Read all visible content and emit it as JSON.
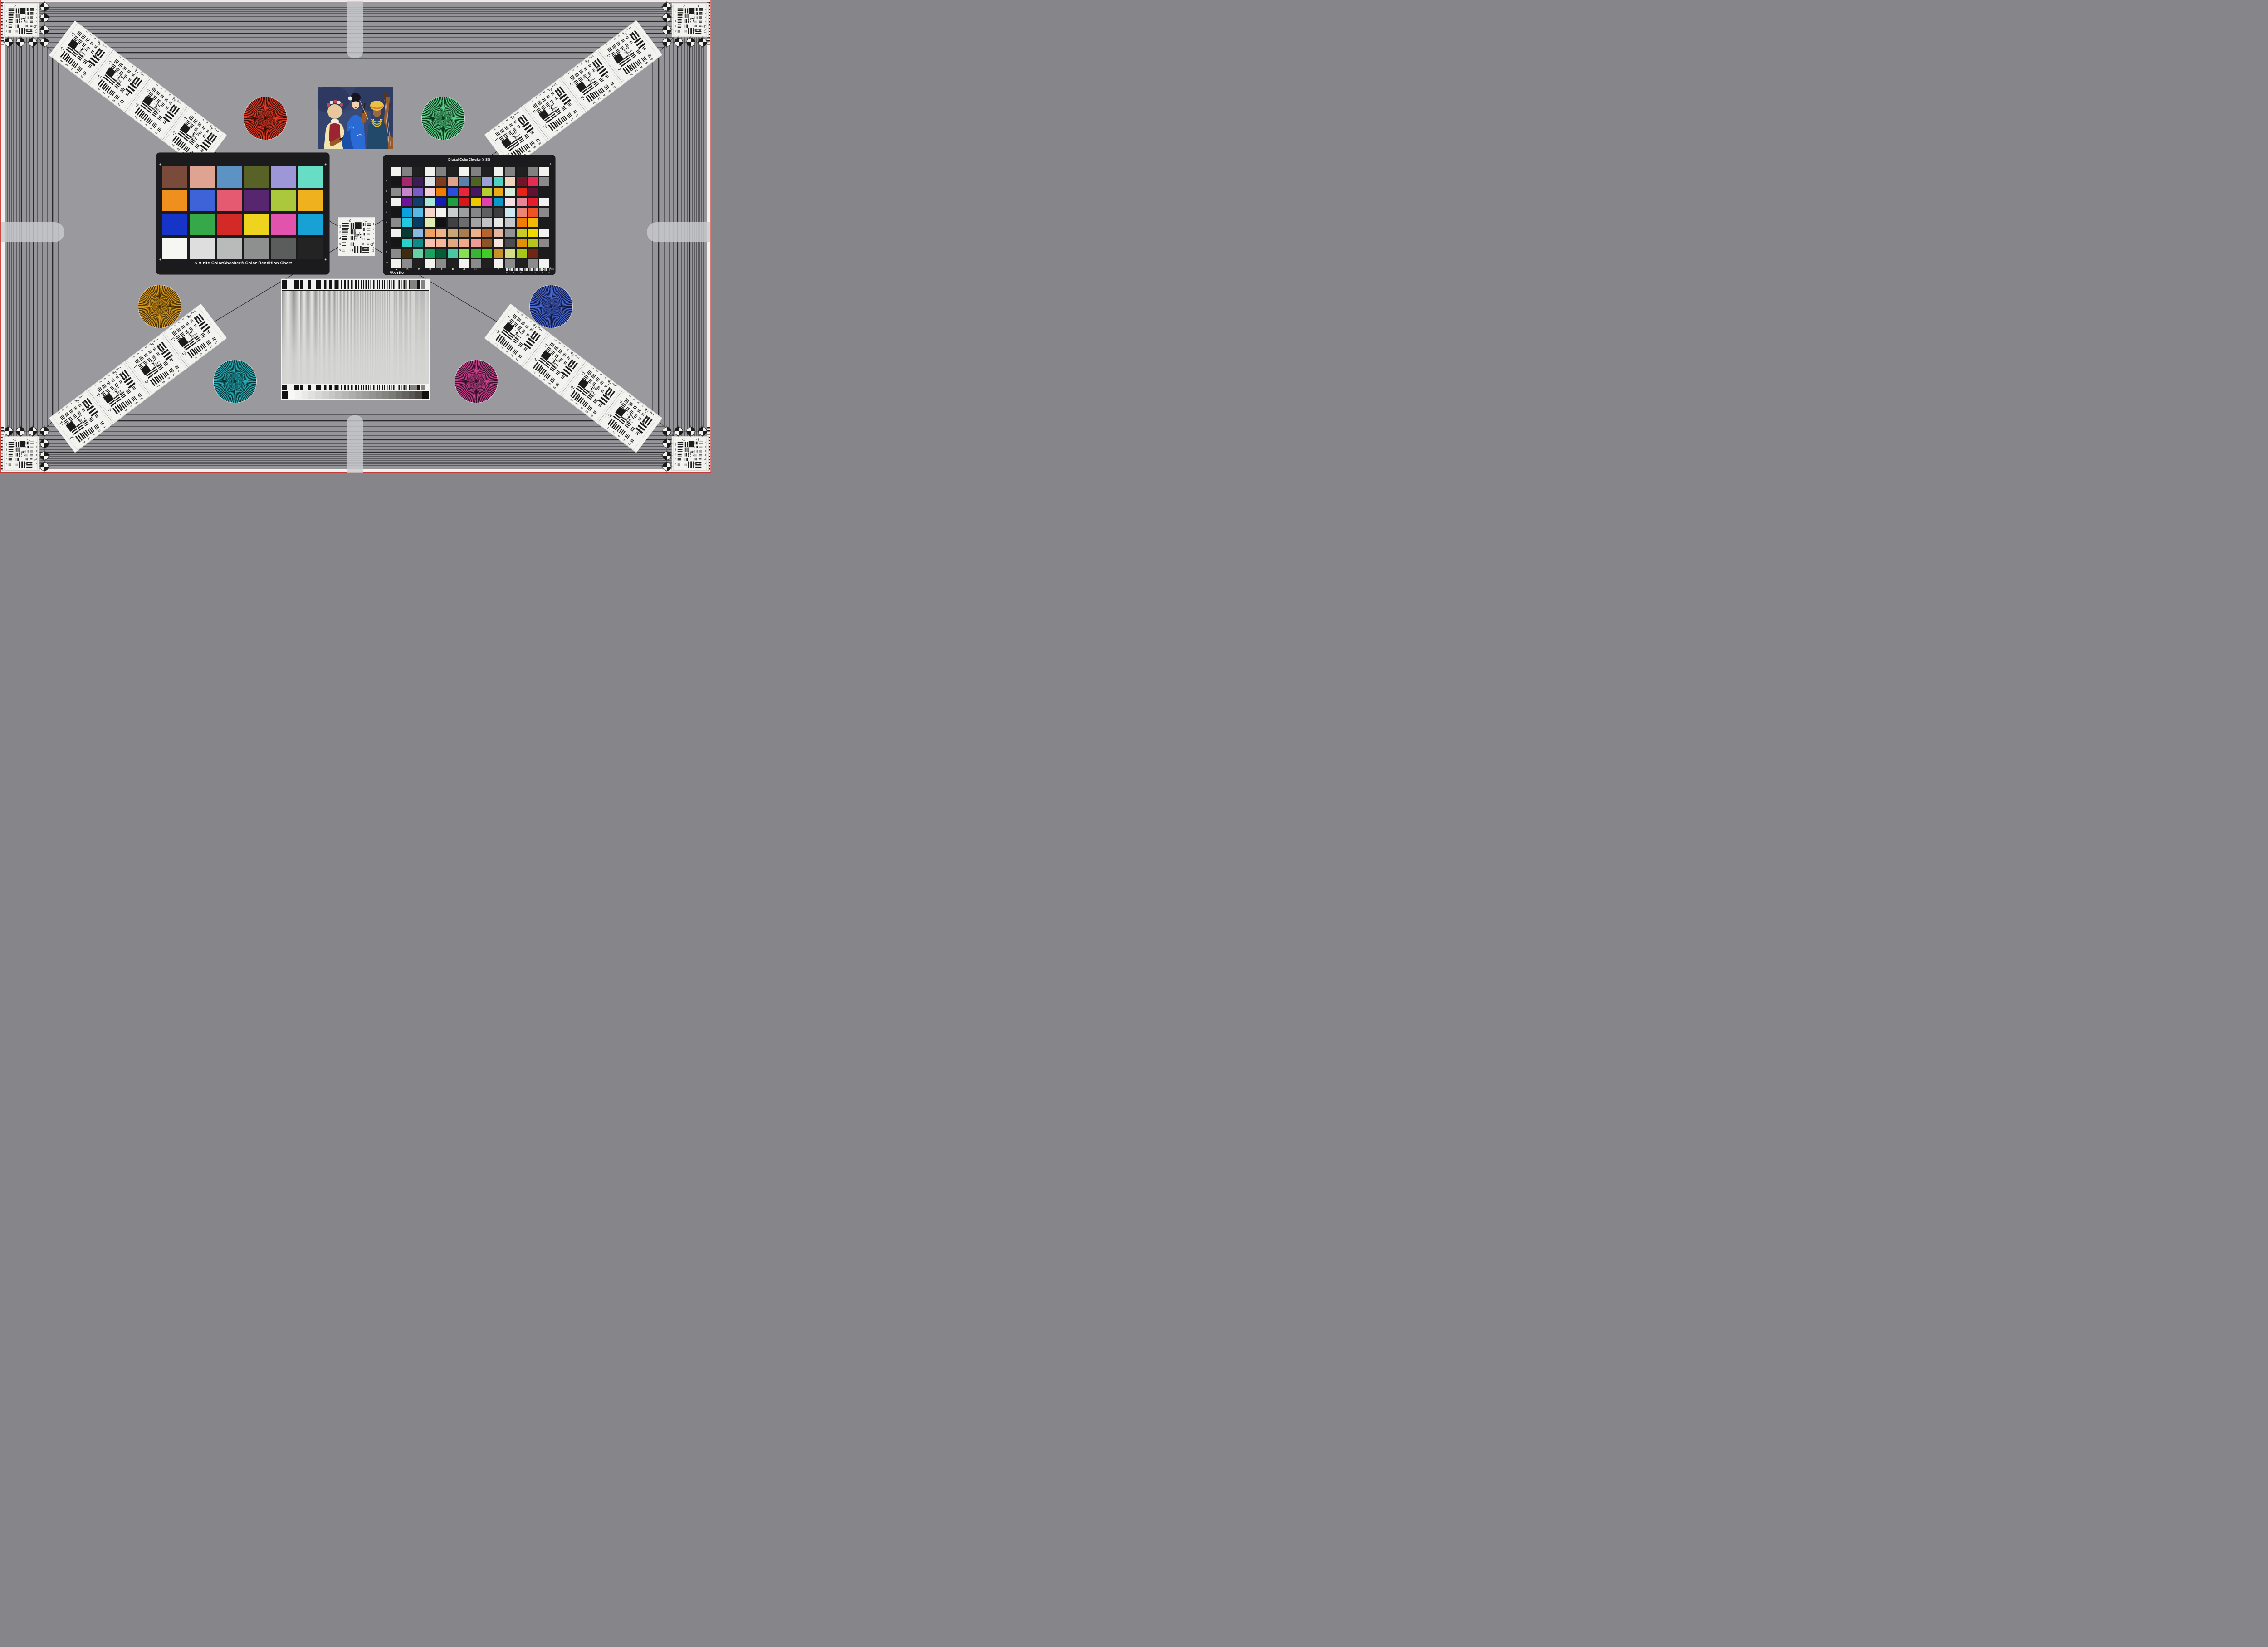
{
  "colors": {
    "background": "#96969a",
    "inner_background": "#9a9a9e",
    "frame_line": "#2a2a2d",
    "diagonal_line": "#26262a",
    "card_black": "#1b1b1d",
    "edge_red": "#c84640",
    "edge_white": "#f1f1ef",
    "arm_gray": "#c9cbce",
    "white_patch": "#f2f2ee",
    "star_rim": "#d4d4d6",
    "usaf_ink": "#1c1c1c"
  },
  "usaf": {
    "top_labels": [
      "-2",
      "-1"
    ],
    "left_labels": [
      "2",
      "3",
      "4",
      "5",
      "6"
    ],
    "right_labels": [
      "1",
      "2",
      "3",
      "4",
      "5",
      "6"
    ],
    "bottom_labels": [
      "-2",
      "1"
    ],
    "center_labels": [
      "0",
      "1"
    ]
  },
  "colorchecker": {
    "logo_text": "x-rite",
    "title": "ColorChecker® Color Rendition Chart",
    "corner_mark": "+",
    "patches": [
      "#7a4b3a",
      "#dfa491",
      "#5d92c4",
      "#586226",
      "#9e97d7",
      "#67ddc5",
      "#ef8f1d",
      "#3e63d9",
      "#e55a70",
      "#58266e",
      "#abc83c",
      "#efb21e",
      "#1634c8",
      "#35a849",
      "#d32a28",
      "#eed31f",
      "#e253ae",
      "#18a1d4",
      "#f6f6f3",
      "#dedede",
      "#b9bbbb",
      "#8e9090",
      "#5b5c5c",
      "#232324"
    ]
  },
  "sg": {
    "title": "Digital ColorChecker® SG",
    "logo_text": "x-rite",
    "corner_mark": "+",
    "row_labels": [
      "1",
      "2",
      "3",
      "4",
      "5",
      "6",
      "7",
      "8",
      "9",
      "10"
    ],
    "col_labels": [
      "A",
      "B",
      "C",
      "D",
      "E",
      "F",
      "G",
      "H",
      "I",
      "J",
      "K",
      "L",
      "M",
      "N"
    ],
    "ruler_numbers": [
      "0",
      "1",
      "2",
      "3",
      "4",
      "5",
      "6"
    ],
    "ruler_unit": "mm",
    "patches": [
      [
        "#f2f2ee",
        "#818181",
        "#202020",
        "#f2f2ee",
        "#818181",
        "#202020",
        "#f2f2ee",
        "#818181",
        "#202020",
        "#f2f2ee",
        "#818181",
        "#202020",
        "#818181",
        "#f2f2ee"
      ],
      [
        "#161616",
        "#a8266c",
        "#3c1e54",
        "#dde5eb",
        "#7c3c1e",
        "#e0a289",
        "#5c80a9",
        "#506323",
        "#9ba0d9",
        "#50d1c1",
        "#f1d5bd",
        "#721529",
        "#e72b53",
        "#8b8b8b"
      ],
      [
        "#8b8b8b",
        "#c684ca",
        "#7b5bc5",
        "#f4d0da",
        "#f07e05",
        "#2b4edc",
        "#e9253d",
        "#471960",
        "#b5cd2f",
        "#ebab17",
        "#d5edd9",
        "#e72316",
        "#5f1231",
        "#1c1c1c"
      ],
      [
        "#f2f2ee",
        "#6b1795",
        "#10406a",
        "#a9e7dd",
        "#111db5",
        "#1f9f3d",
        "#d51919",
        "#edc900",
        "#e141a9",
        "#0999c9",
        "#f7e1e5",
        "#e98599",
        "#e51d2d",
        "#f2f2ee"
      ],
      [
        "#161616",
        "#0ba1e1",
        "#59b9e5",
        "#f7d5cd",
        "#f3f3ef",
        "#c9cdcd",
        "#9b9f9f",
        "#858789",
        "#5d5f61",
        "#3b3d3f",
        "#cde9f1",
        "#ed8575",
        "#f15125",
        "#8b8b8b"
      ],
      [
        "#8b8b8b",
        "#21c9e1",
        "#073d65",
        "#ddedb5",
        "#111113",
        "#414143",
        "#6b6d6f",
        "#a1a3a5",
        "#c1c3c5",
        "#e7e7e5",
        "#c5c7c9",
        "#f17d05",
        "#f1b905",
        "#1c1c1c"
      ],
      [
        "#f2f2ee",
        "#053d35",
        "#89b9e1",
        "#eda15d",
        "#f1b189",
        "#cba573",
        "#a97d4f",
        "#efb18d",
        "#b5652b",
        "#e5b5a1",
        "#919395",
        "#c9cd21",
        "#f1d900",
        "#f2f2ee"
      ],
      [
        "#161616",
        "#2bd1c9",
        "#0d8b85",
        "#f5c1b1",
        "#f5b999",
        "#e1a981",
        "#f1a989",
        "#ed9d95",
        "#8d5525",
        "#f5e5dd",
        "#4b4d4f",
        "#e19105",
        "#b5c51d",
        "#8b8b8b"
      ],
      [
        "#8b8b8b",
        "#3d2d0d",
        "#65d1a5",
        "#19a15d",
        "#055d35",
        "#49c9a1",
        "#85e14d",
        "#39b535",
        "#41cd25",
        "#c99125",
        "#d5dd85",
        "#a5c915",
        "#712515",
        "#1c1c1c"
      ],
      [
        "#f2f2ee",
        "#8b8b8b",
        "#202020",
        "#f2f2ee",
        "#8b8b8b",
        "#202020",
        "#f2f2ee",
        "#8b8b8b",
        "#202020",
        "#f2f2ee",
        "#8b8b8b",
        "#202020",
        "#8b8b8b",
        "#f2f2ee"
      ]
    ]
  },
  "stars": [
    {
      "name": "red-star",
      "bright": "#d63c26",
      "dark": "#400d07"
    },
    {
      "name": "green-star",
      "bright": "#5dc887",
      "dark": "#093a1b"
    },
    {
      "name": "orange-star",
      "bright": "#d2961f",
      "dark": "#4a3303"
    },
    {
      "name": "blue-star",
      "bright": "#4867cb",
      "dark": "#131b4b"
    },
    {
      "name": "teal-star",
      "bright": "#2aa8b0",
      "dark": "#05363a"
    },
    {
      "name": "magenta-star",
      "bright": "#c24389",
      "dark": "#3a0f2b"
    }
  ],
  "sweep": {
    "bar_dark": "#141414",
    "bar_light": "#f2f2f0",
    "cap_color": "#101010",
    "steps": [
      "#f8f8f6",
      "#f1f1ef",
      "#e9e9e7",
      "#e0e0de",
      "#d8d8d6",
      "#d0d0ce",
      "#c7c7c5",
      "#bfbfbd",
      "#b6b6b4",
      "#aeaeac",
      "#a5a5a3",
      "#9d9d9b",
      "#949492",
      "#8c8c8a",
      "#83837f",
      "#7a7a76",
      "#6f6d69",
      "#646260",
      "#585654",
      "#4a4644"
    ]
  },
  "portrait": {
    "backdrop": "#35446e",
    "backdrop_dark": "#273155",
    "backdrop_light": "#4a5a8e",
    "w1_hair": "#e3cd94",
    "w1_skin": "#eec3a4",
    "w1_blouse": "#f2e4ae",
    "w1_vest": "#9c2330",
    "w1_wreath": "#b8485a",
    "w2_hair": "#14141e",
    "w2_skin": "#f3d2b4",
    "w2_kimono": "#2a6ad4",
    "w2_kimono_dark": "#1c4ea6",
    "w2_lips": "#b02030",
    "w3_turban": "#e9c042",
    "w3_turban_stripe": "#d08030",
    "w3_skin": "#9c6844",
    "w3_outfit": "#22486a",
    "w3_beads": "#e8c23c",
    "wood": "#9a5a26",
    "wood_dark": "#5e3414"
  }
}
